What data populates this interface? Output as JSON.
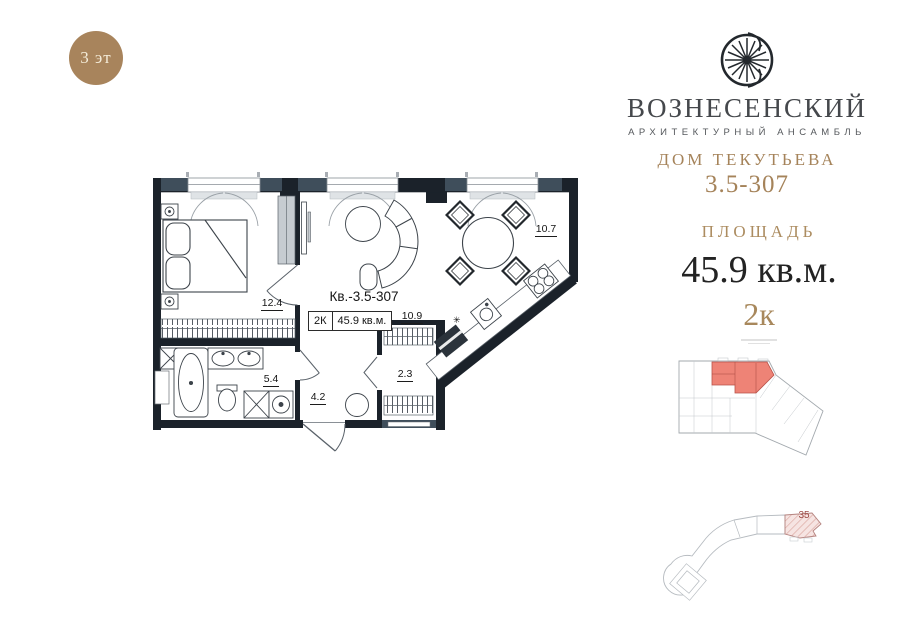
{
  "floor_badge": {
    "label": "3 эт"
  },
  "brand": {
    "name": "ВОЗНЕСЕНСКИЙ",
    "tagline": "АРХИТЕКТУРНЫЙ АНСАМБЛЬ",
    "building": "ДОМ ТЕКУТЬЕВА",
    "unit_number": "3.5-307"
  },
  "area_info": {
    "label": "ПЛОЩАДЬ",
    "value": "45.9 кв.м.",
    "rooms": "2к"
  },
  "floor_plan": {
    "apartment_label": "Кв.-3.5-307",
    "spec_rooms": "2К",
    "spec_area": "45.9 кв.м.",
    "room_areas": {
      "bedroom": "12.4",
      "dining": "10.7",
      "kitchen_hall": "10.9",
      "bathroom": "5.4",
      "hallway": "4.2",
      "wardrobe": "2.3"
    },
    "kitchen_vent_symbol": "✳"
  },
  "site_plan": {
    "building_section": "35"
  },
  "colors": {
    "brand_gold": "#a5835a",
    "badge_brown": "#a8845c",
    "wall_dark": "#1b222a",
    "wall_slate": "#3f4e5b",
    "highlight_red": "#ee8376"
  }
}
